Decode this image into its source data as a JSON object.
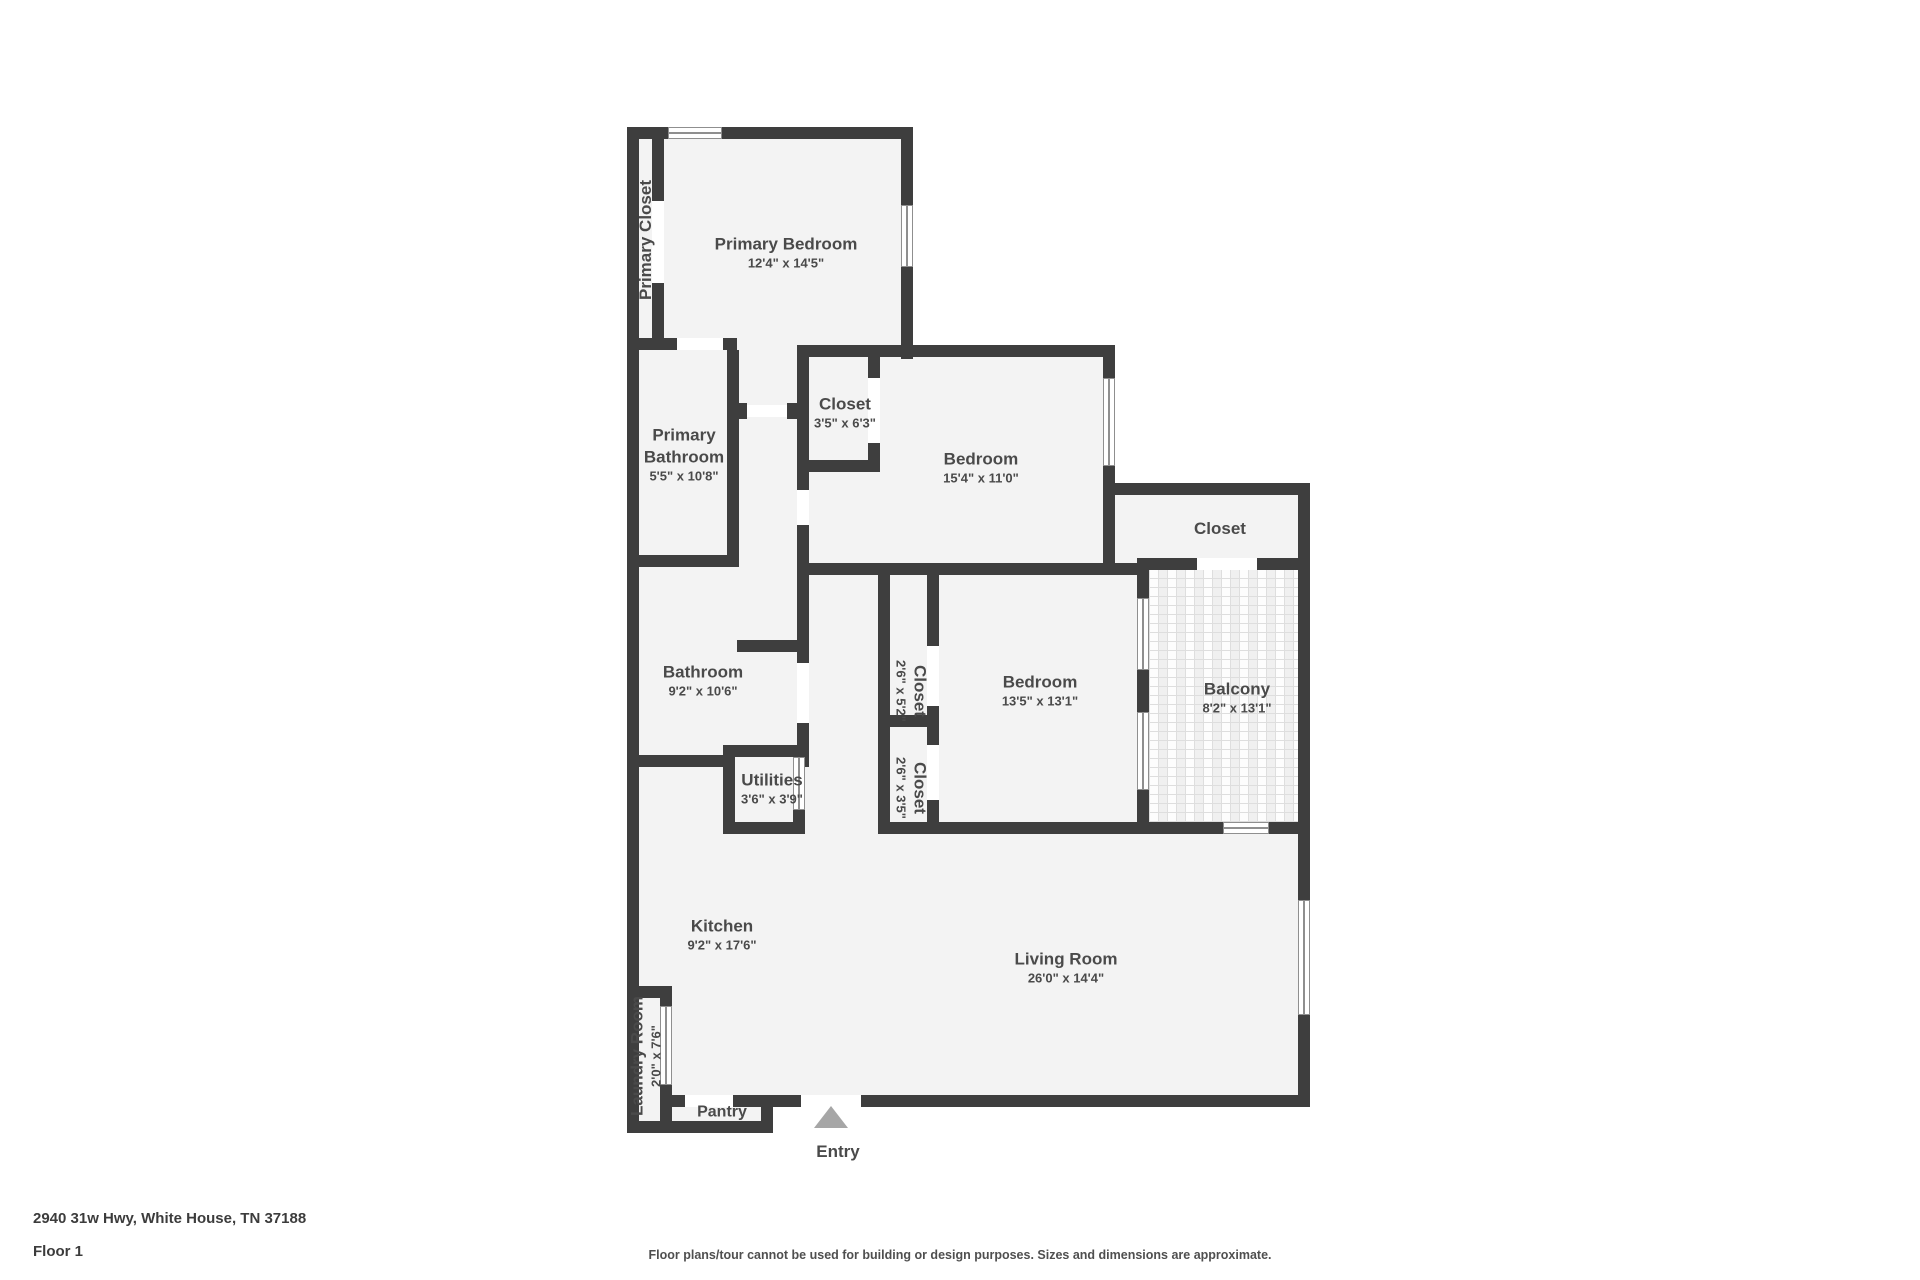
{
  "rooms": {
    "primary_closet": {
      "name": "Primary Closet"
    },
    "primary_bedroom": {
      "name": "Primary Bedroom",
      "dims": "12'4\" x 14'5\""
    },
    "primary_bathroom": {
      "name": "Primary Bathroom",
      "dims": "5'5\" x 10'8\""
    },
    "closet_a": {
      "name": "Closet",
      "dims": "3'5\" x 6'3\""
    },
    "bedroom_a": {
      "name": "Bedroom",
      "dims": "15'4\" x 11'0\""
    },
    "closet_b": {
      "name": "Closet"
    },
    "bathroom": {
      "name": "Bathroom",
      "dims": "9'2\" x 10'6\""
    },
    "utilities": {
      "name": "Utilities",
      "dims": "3'6\" x 3'9\""
    },
    "closet_c": {
      "name": "Closet",
      "dims": "2'6\" x 5'2\""
    },
    "bedroom_b": {
      "name": "Bedroom",
      "dims": "13'5\" x 13'1\""
    },
    "balcony": {
      "name": "Balcony",
      "dims": "8'2\" x 13'1\""
    },
    "closet_d": {
      "name": "Closet",
      "dims": "2'6\" x 3'5\""
    },
    "kitchen": {
      "name": "Kitchen",
      "dims": "9'2\" x 17'6\""
    },
    "living_room": {
      "name": "Living Room",
      "dims": "26'0\" x 14'4\""
    },
    "laundry_room": {
      "name": "Laundry Room",
      "dims": "2'0\" x 7'6\""
    },
    "pantry": {
      "name": "Pantry"
    },
    "entry": {
      "name": "Entry"
    }
  },
  "footer": {
    "address": "2940 31w Hwy, White House, TN 37188",
    "floor": "Floor 1",
    "disclaimer": "Floor plans/tour cannot be used for building or design purposes. Sizes and dimensions are approximate."
  },
  "colors": {
    "wall": "#3e3e3e",
    "floor": "#f3f3f3",
    "text": "#4a4a4a",
    "entry_arrow": "#a6a6a6"
  }
}
